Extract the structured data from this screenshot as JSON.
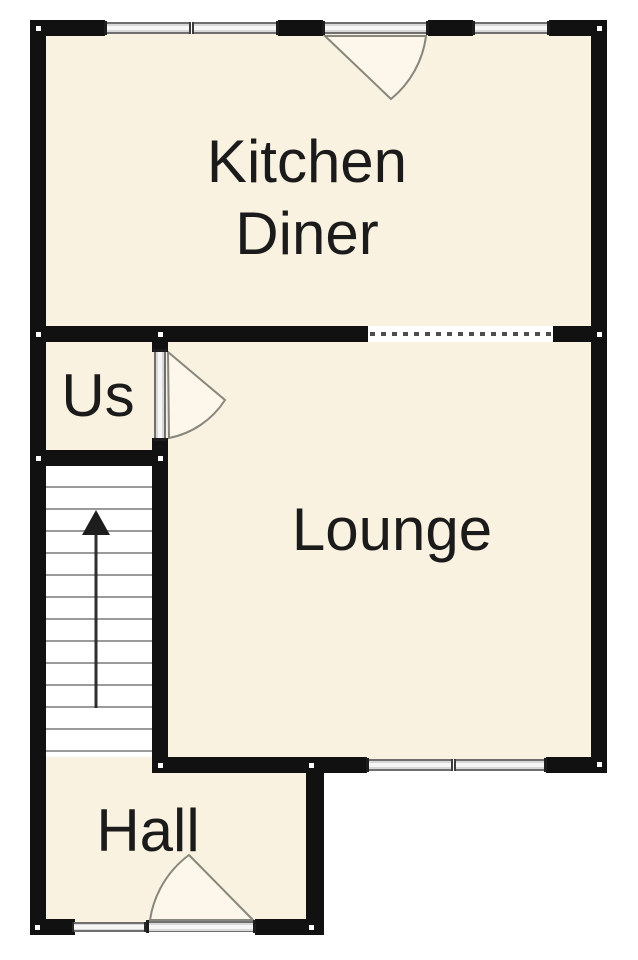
{
  "floorplan": {
    "rooms": [
      {
        "id": "kitchen-diner",
        "label_line1": "Kitchen",
        "label_line2": "Diner"
      },
      {
        "id": "us",
        "label": "Us"
      },
      {
        "id": "lounge",
        "label": "Lounge"
      },
      {
        "id": "hall",
        "label": "Hall"
      }
    ],
    "stairs": {
      "arrow_direction": "up"
    },
    "colors": {
      "room_fill": "#faf2e0",
      "wall": "#111111",
      "window_fill": "#d8d8d8",
      "door_swing_stroke": "#87877e",
      "door_swing_fill": "#fcf7ea",
      "stair_tread": "#9a9a9a",
      "label_text": "#1b1b1b",
      "background": "#ffffff"
    }
  }
}
